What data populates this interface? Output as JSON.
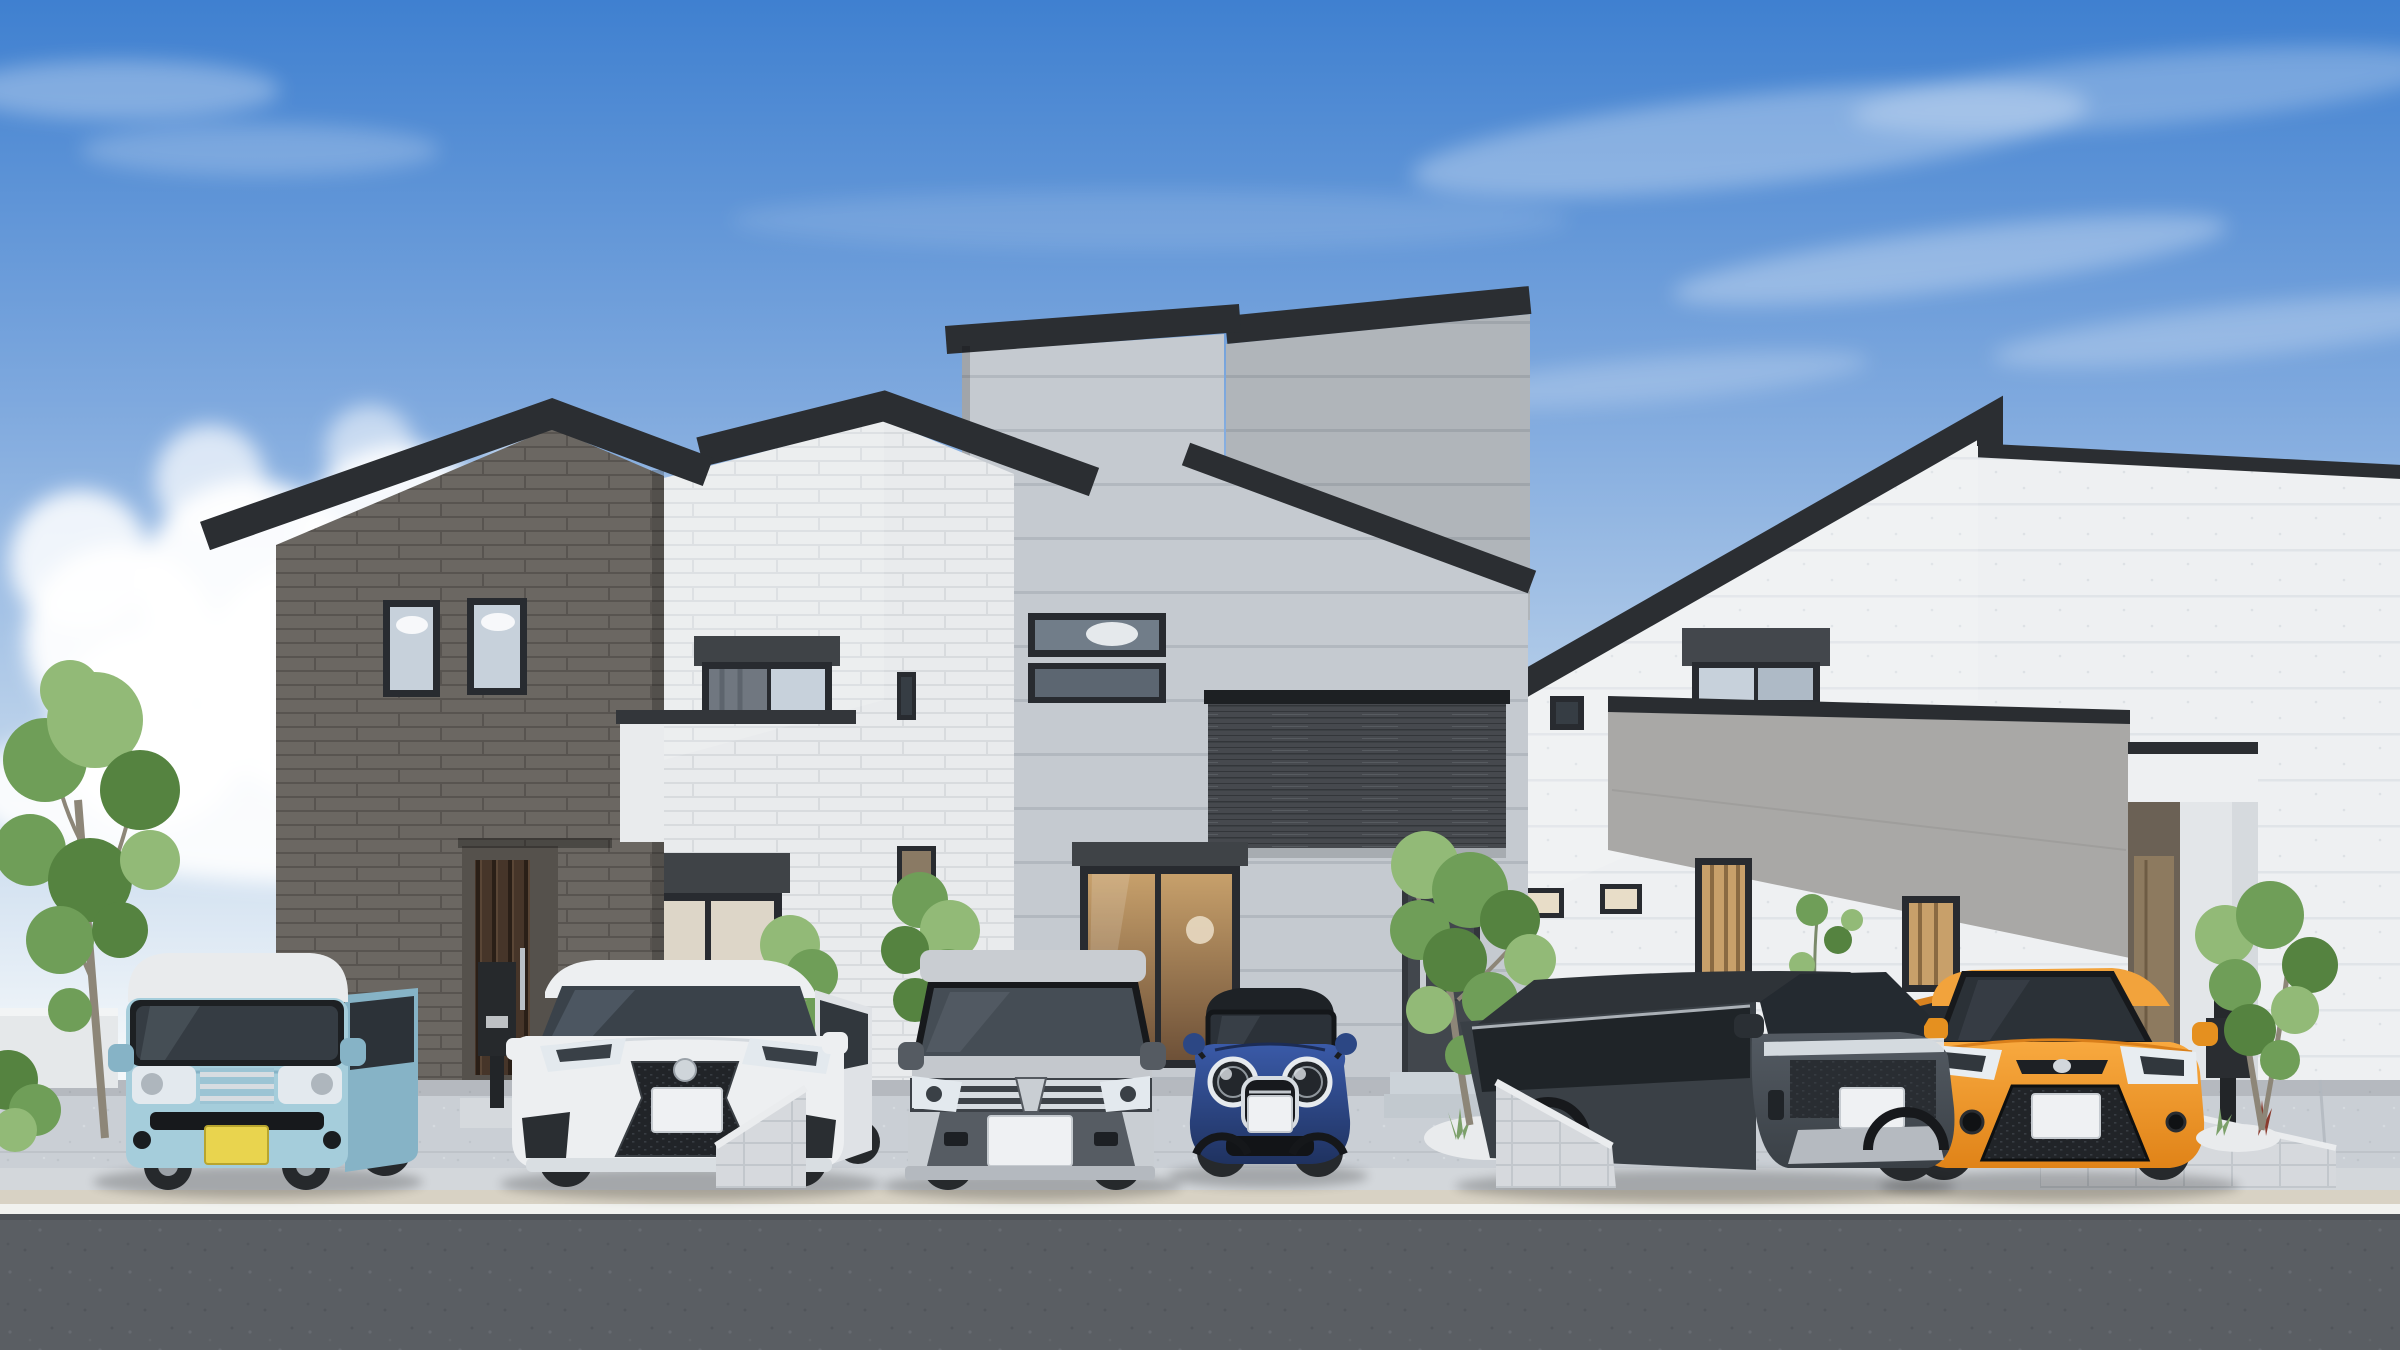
{
  "meta": {
    "title": "3D architectural rendering of three modern two-story houses with six parked cars",
    "type": "photorealistic exterior visualization",
    "width_px": 2400,
    "height_px": 1350
  },
  "palette": {
    "sky_top": "#3f80d0",
    "sky_mid": "#7fa9de",
    "sky_low": "#c3d7ec",
    "sky_horizon": "#f3f7fa",
    "cloud": "#ffffff",
    "roof_dark": "#2b2e32",
    "brick_dark": "#6b6762",
    "brick_dark_joint": "#585450",
    "brick_white": "#e9ebed",
    "brick_white_joint": "#d8dbde",
    "siding_gray": "#c5cad0",
    "siding_gray_joint": "#b2b8bf",
    "siding_gray_shade": "#aab1b9",
    "siding_white": "#eef0f2",
    "siding_white_joint": "#e0e4e8",
    "wood_band": "#46494e",
    "wood_band_joint": "#33363a",
    "parapet_gray": "#a9a8a6",
    "window_frame": "#282b30",
    "glass_sky": "#c7d1db",
    "glass_dark": "#363d44",
    "glass_warm": "#c8a06a",
    "door_wood": "#463529",
    "door_gray": "#42474d",
    "porch_door": "#8d7a5f",
    "concrete": "#cacfd5",
    "concrete_joint": "#b2b8bf",
    "sidewalk": "#d3d7db",
    "curb": "#d8d2c4",
    "white_line": "#f1f2ef",
    "asphalt": "#5a5e63",
    "block_wall": "#d6d9dd",
    "block_joint": "#c2c7cc",
    "leaf": "#6f9e58",
    "leaf_dark": "#558340",
    "leaf_light": "#92ba77",
    "trunk": "#8d8678",
    "van_blue": "#a5cddb",
    "van_blue_dark": "#86b3c6",
    "van_roof": "#e9ebed",
    "lexus_white": "#edeff1",
    "lexus_shade": "#dfe2e6",
    "voxy_silver": "#c4c8cd",
    "voxy_dark": "#565c63",
    "mini_roof": "#1e2226",
    "suv_side": "#3a4046",
    "chrome": "#d7dce1",
    "tire": "#26292c",
    "hub": "#9ba1a7",
    "headlight": "#e3e9ee",
    "plate_yellow": "#e9d44e",
    "plate_white": "#eff1f3"
  },
  "scene": {
    "sky": {
      "weather": "sunny blue sky",
      "clouds_left": "large cumulus cluster",
      "clouds_right": "thin cirrus streaks",
      "horizon": "pale white haze"
    },
    "houses": [
      {
        "id": "house-left",
        "style": "two-story asymmetric gable",
        "facade": "dark gray brick with white brick right wing",
        "features": [
          "two tall upper windows",
          "recessed wood-slat entry door",
          "entry canopy",
          "white balcony parapet",
          "curtained upper window",
          "shuttered picture window",
          "black intercom post"
        ]
      },
      {
        "id": "house-middle",
        "style": "two-story stepped shed roofs",
        "facade": "light gray horizontal siding",
        "features": [
          "two horizontal slit windows",
          "dark wood balcony band",
          "large glass slider with warm interior",
          "gray entry door",
          "tiled entry steps",
          "pebble garden with plants",
          "black mail post"
        ]
      },
      {
        "id": "house-right",
        "style": "two-story steep mono-pitch",
        "facade": "white speckled siding",
        "features": [
          "gray balcony parapet band",
          "wide upper window",
          "vertical-slat warm windows",
          "small slit windows",
          "white entry porch with column",
          "black mail post",
          "wall vine"
        ]
      }
    ],
    "cars": [
      {
        "id": "car-1",
        "type": "kei box van",
        "color_name": "light blue with white roof",
        "body_color": "#a5cddb",
        "plate": "yellow kei plate, blank"
      },
      {
        "id": "car-2",
        "type": "luxury SUV with spindle grille",
        "color_name": "white",
        "body_color": "#edeff1",
        "plate": "white, blank"
      },
      {
        "id": "car-3",
        "type": "boxy minivan",
        "color_name": "silver",
        "body_color": "#c4c8cd",
        "plate": "white, blank"
      },
      {
        "id": "car-4",
        "type": "compact hatchback with round headlights",
        "color_name": "dark blue with black roof",
        "body_color": "#2e4a8f",
        "plate": "white, blank"
      },
      {
        "id": "car-5",
        "type": "crossover SUV",
        "color_name": "dark gray",
        "body_color": "#4b5158",
        "plate": "white, blank"
      },
      {
        "id": "car-6",
        "type": "subcompact hatchback",
        "color_name": "orange",
        "body_color": "#f49b2e",
        "plate": "white, blank"
      }
    ],
    "ground": {
      "driveway": "light concrete aprons with joint lines",
      "dividers": "low concrete block walls between plots",
      "curb": "beige curb strip",
      "marking": "white edge line",
      "road": "dark asphalt"
    },
    "vegetation": [
      "slender tree far left",
      "corner shrubs",
      "two small trees center",
      "entry tree at middle house",
      "multi-stem tree at right house",
      "climbing vine on white wall",
      "pebble-bed plants"
    ]
  }
}
